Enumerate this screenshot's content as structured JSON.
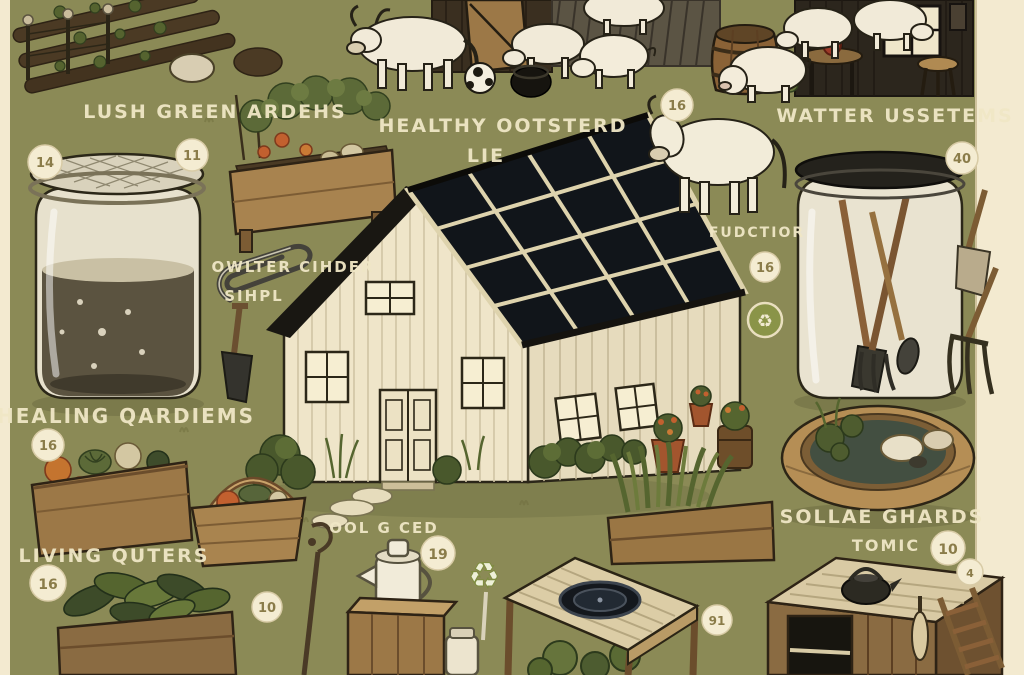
{
  "scene": {
    "description": "Hand-drawn homestead / off-grid living infographic illustration",
    "background_color": "#8b8a56",
    "paper_color": "#f3ead0",
    "label_color": "#f0e7c6",
    "badge_fill": "#f4ecd2",
    "badge_text_color": "#8a7c49",
    "solar_panel_color": "#1c232e",
    "roof_color": "#191712",
    "house_color": "#efe5c9",
    "wood_color": "#a07c4a",
    "foliage_color": "#55652f",
    "recycle_badge_color": "#8a9448"
  },
  "labels": {
    "lush_green_gardens": "LUSH GREEN ARDEHS",
    "healthy_line1": "HEALTHY OOTSTERD",
    "healthy_line2": "LIE",
    "water_systems": "WATTER USSETEMS",
    "owlter_cihder": "OWLTER CIHDER",
    "sihpl": "SIHPL",
    "fudctior": "FUDCTIOR",
    "healing_gardens": "HEALING QARDIEMS",
    "living_quarters": "LIVING QUTERS",
    "ool_g_ced": "OOL G CED",
    "sollab_line1": "SOLLAE GHARDS",
    "sollab_line2": "TOMIC"
  },
  "badges": [
    {
      "value": "14"
    },
    {
      "value": "11"
    },
    {
      "value": "16"
    },
    {
      "value": "40"
    },
    {
      "value": "16"
    },
    {
      "value": "16"
    },
    {
      "value": "16"
    },
    {
      "value": "19"
    },
    {
      "value": "10"
    },
    {
      "value": "10"
    },
    {
      "value": "4"
    },
    {
      "value": "91"
    }
  ],
  "icons": {
    "recycle": "♻"
  }
}
